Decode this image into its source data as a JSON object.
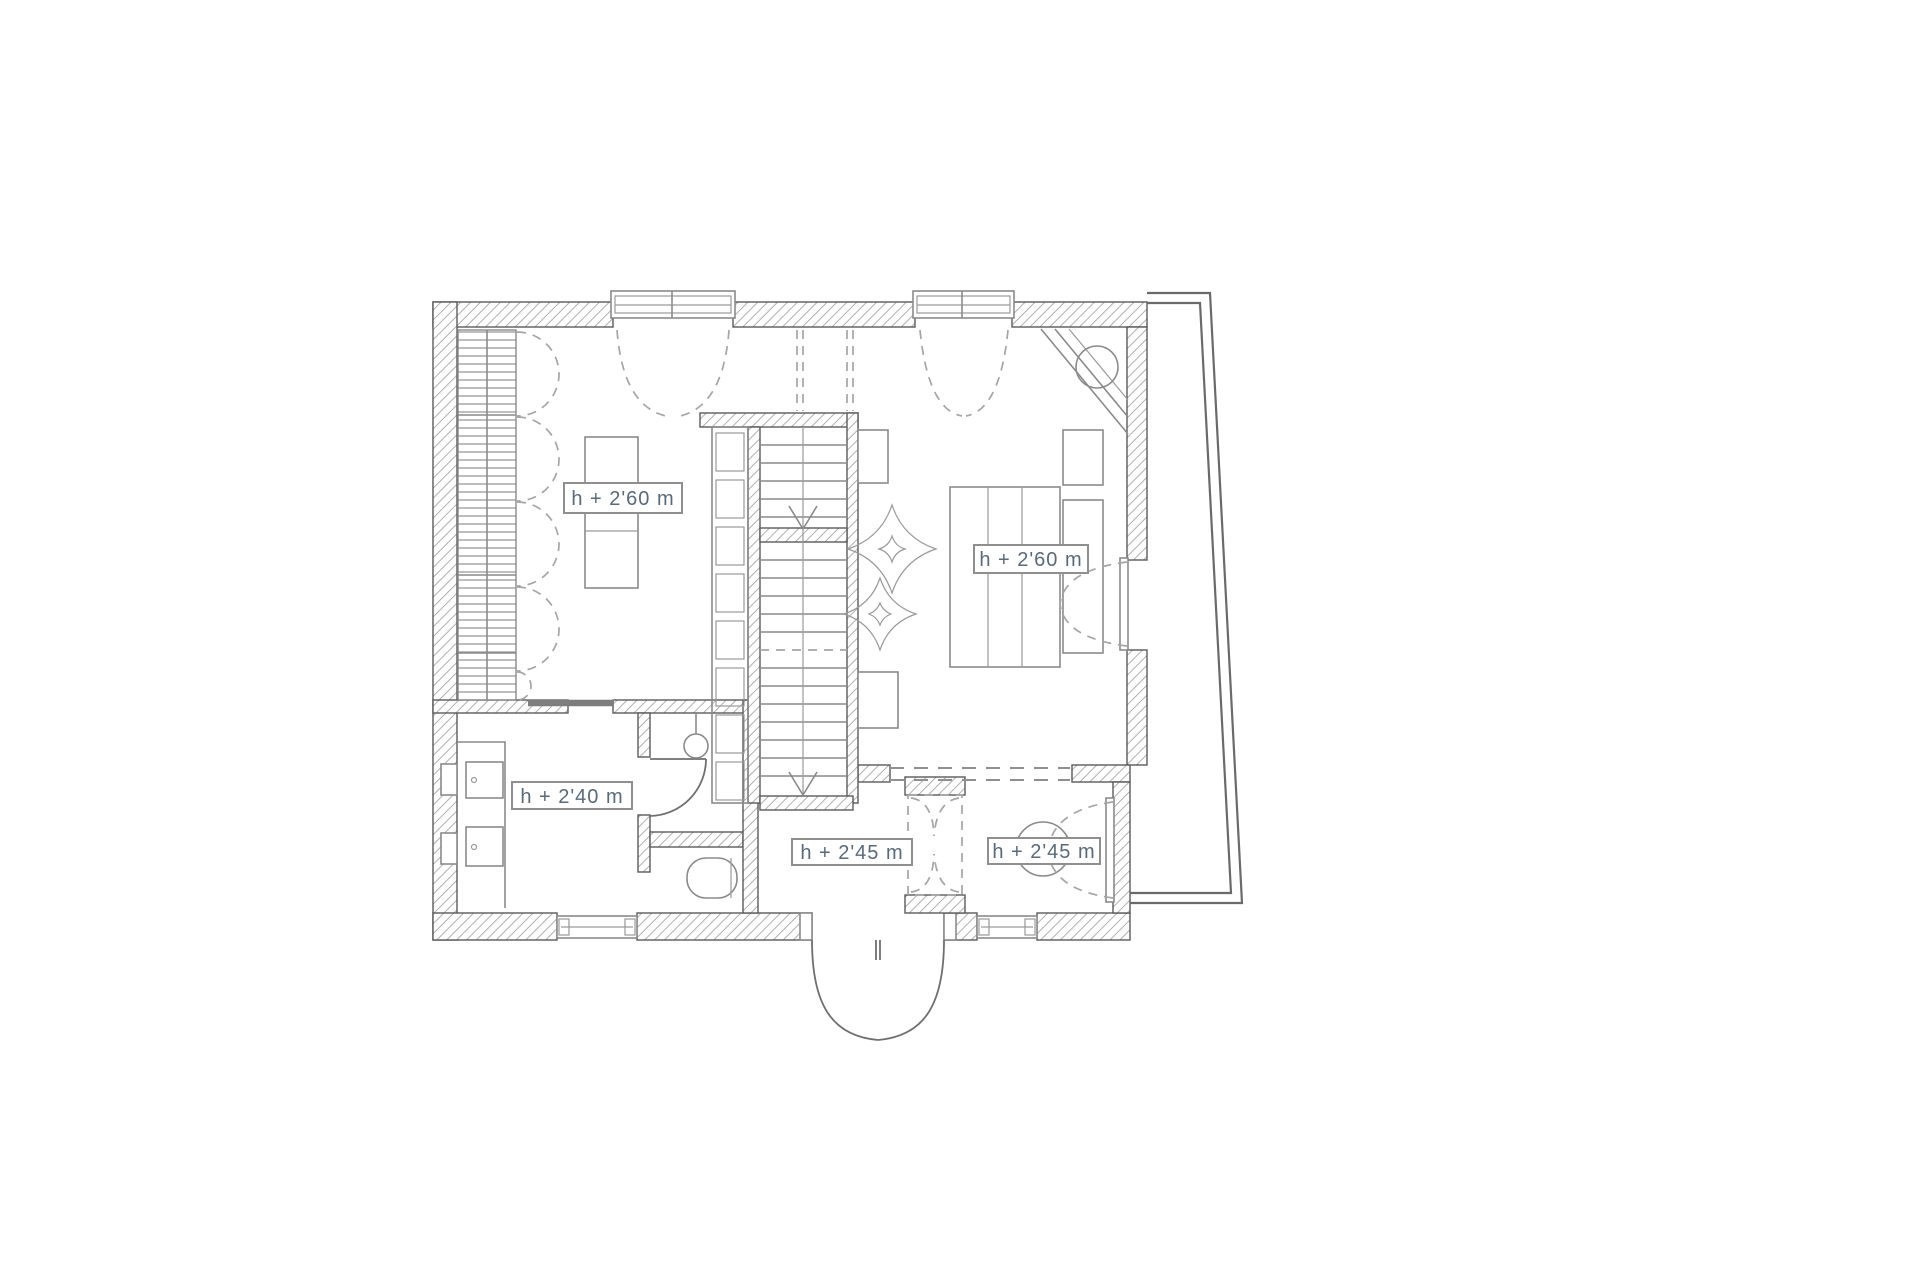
{
  "plan": {
    "type": "architectural-floor-plan",
    "background": "#ffffff",
    "colors": {
      "wall_outline": "#5a5a5a",
      "wall_hatch": "#b0b0b0",
      "furniture_line": "#8a8a8a",
      "dashed_line": "#a5a5a5",
      "sliding_door": "#7d7d7d",
      "label_text": "#5a6a78",
      "label_border": "#8f8f8f"
    },
    "height_labels": {
      "dressing_room": "h + 2'60 m",
      "bedroom": "h + 2'60 m",
      "bathroom": "h + 2'40 m",
      "hallway": "h + 2'45 m",
      "terrace_room": "h + 2'45 m"
    }
  }
}
